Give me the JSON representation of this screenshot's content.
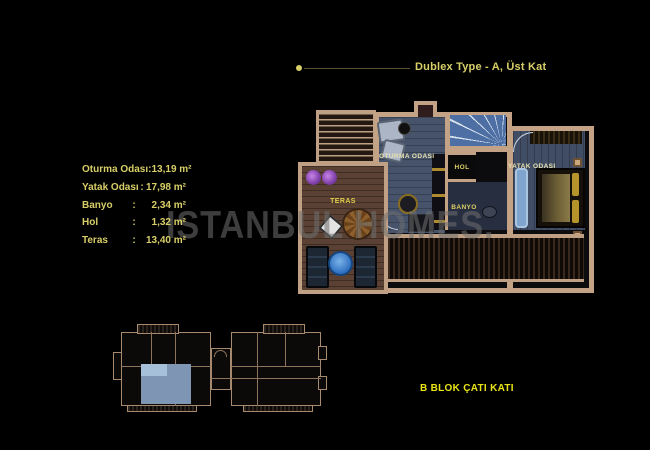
{
  "header": {
    "title": "Dublex Type - A, Üst Kat"
  },
  "legend": {
    "rows": [
      {
        "label": "Oturma Odası",
        "sep": ":",
        "value": "13,19 m²"
      },
      {
        "label": "Yatak Odası",
        "sep": ":",
        "value": "17,98 m²"
      },
      {
        "label": "Banyo",
        "sep": ":",
        "value": "2,34 m²"
      },
      {
        "label": "Hol",
        "sep": ":",
        "value": "1,32 m²"
      },
      {
        "label": "Teras",
        "sep": ":",
        "value": "13,40 m²"
      }
    ]
  },
  "watermark": {
    "text": "ISTANBUL HOMES."
  },
  "plan": {
    "rooms": {
      "living": "OTURMA ODASI",
      "hall": "HOL",
      "bath": "BANYO",
      "bedroom": "YATAK ODASI",
      "terrace": "TERAS"
    }
  },
  "keyplan": {
    "label": "B BLOK ÇATI KATI"
  },
  "colors": {
    "background": "#000000",
    "accent_yellow": "#d8cf68",
    "bright_yellow": "#e9e414",
    "wall_tan": "#c3a285",
    "floor_slate": "#46536b",
    "stair_blue": "#4d6fa3",
    "terrace_wood": "#5a4134",
    "highlight_blue": "#7e95b3",
    "watermark_gray": "#707070"
  }
}
